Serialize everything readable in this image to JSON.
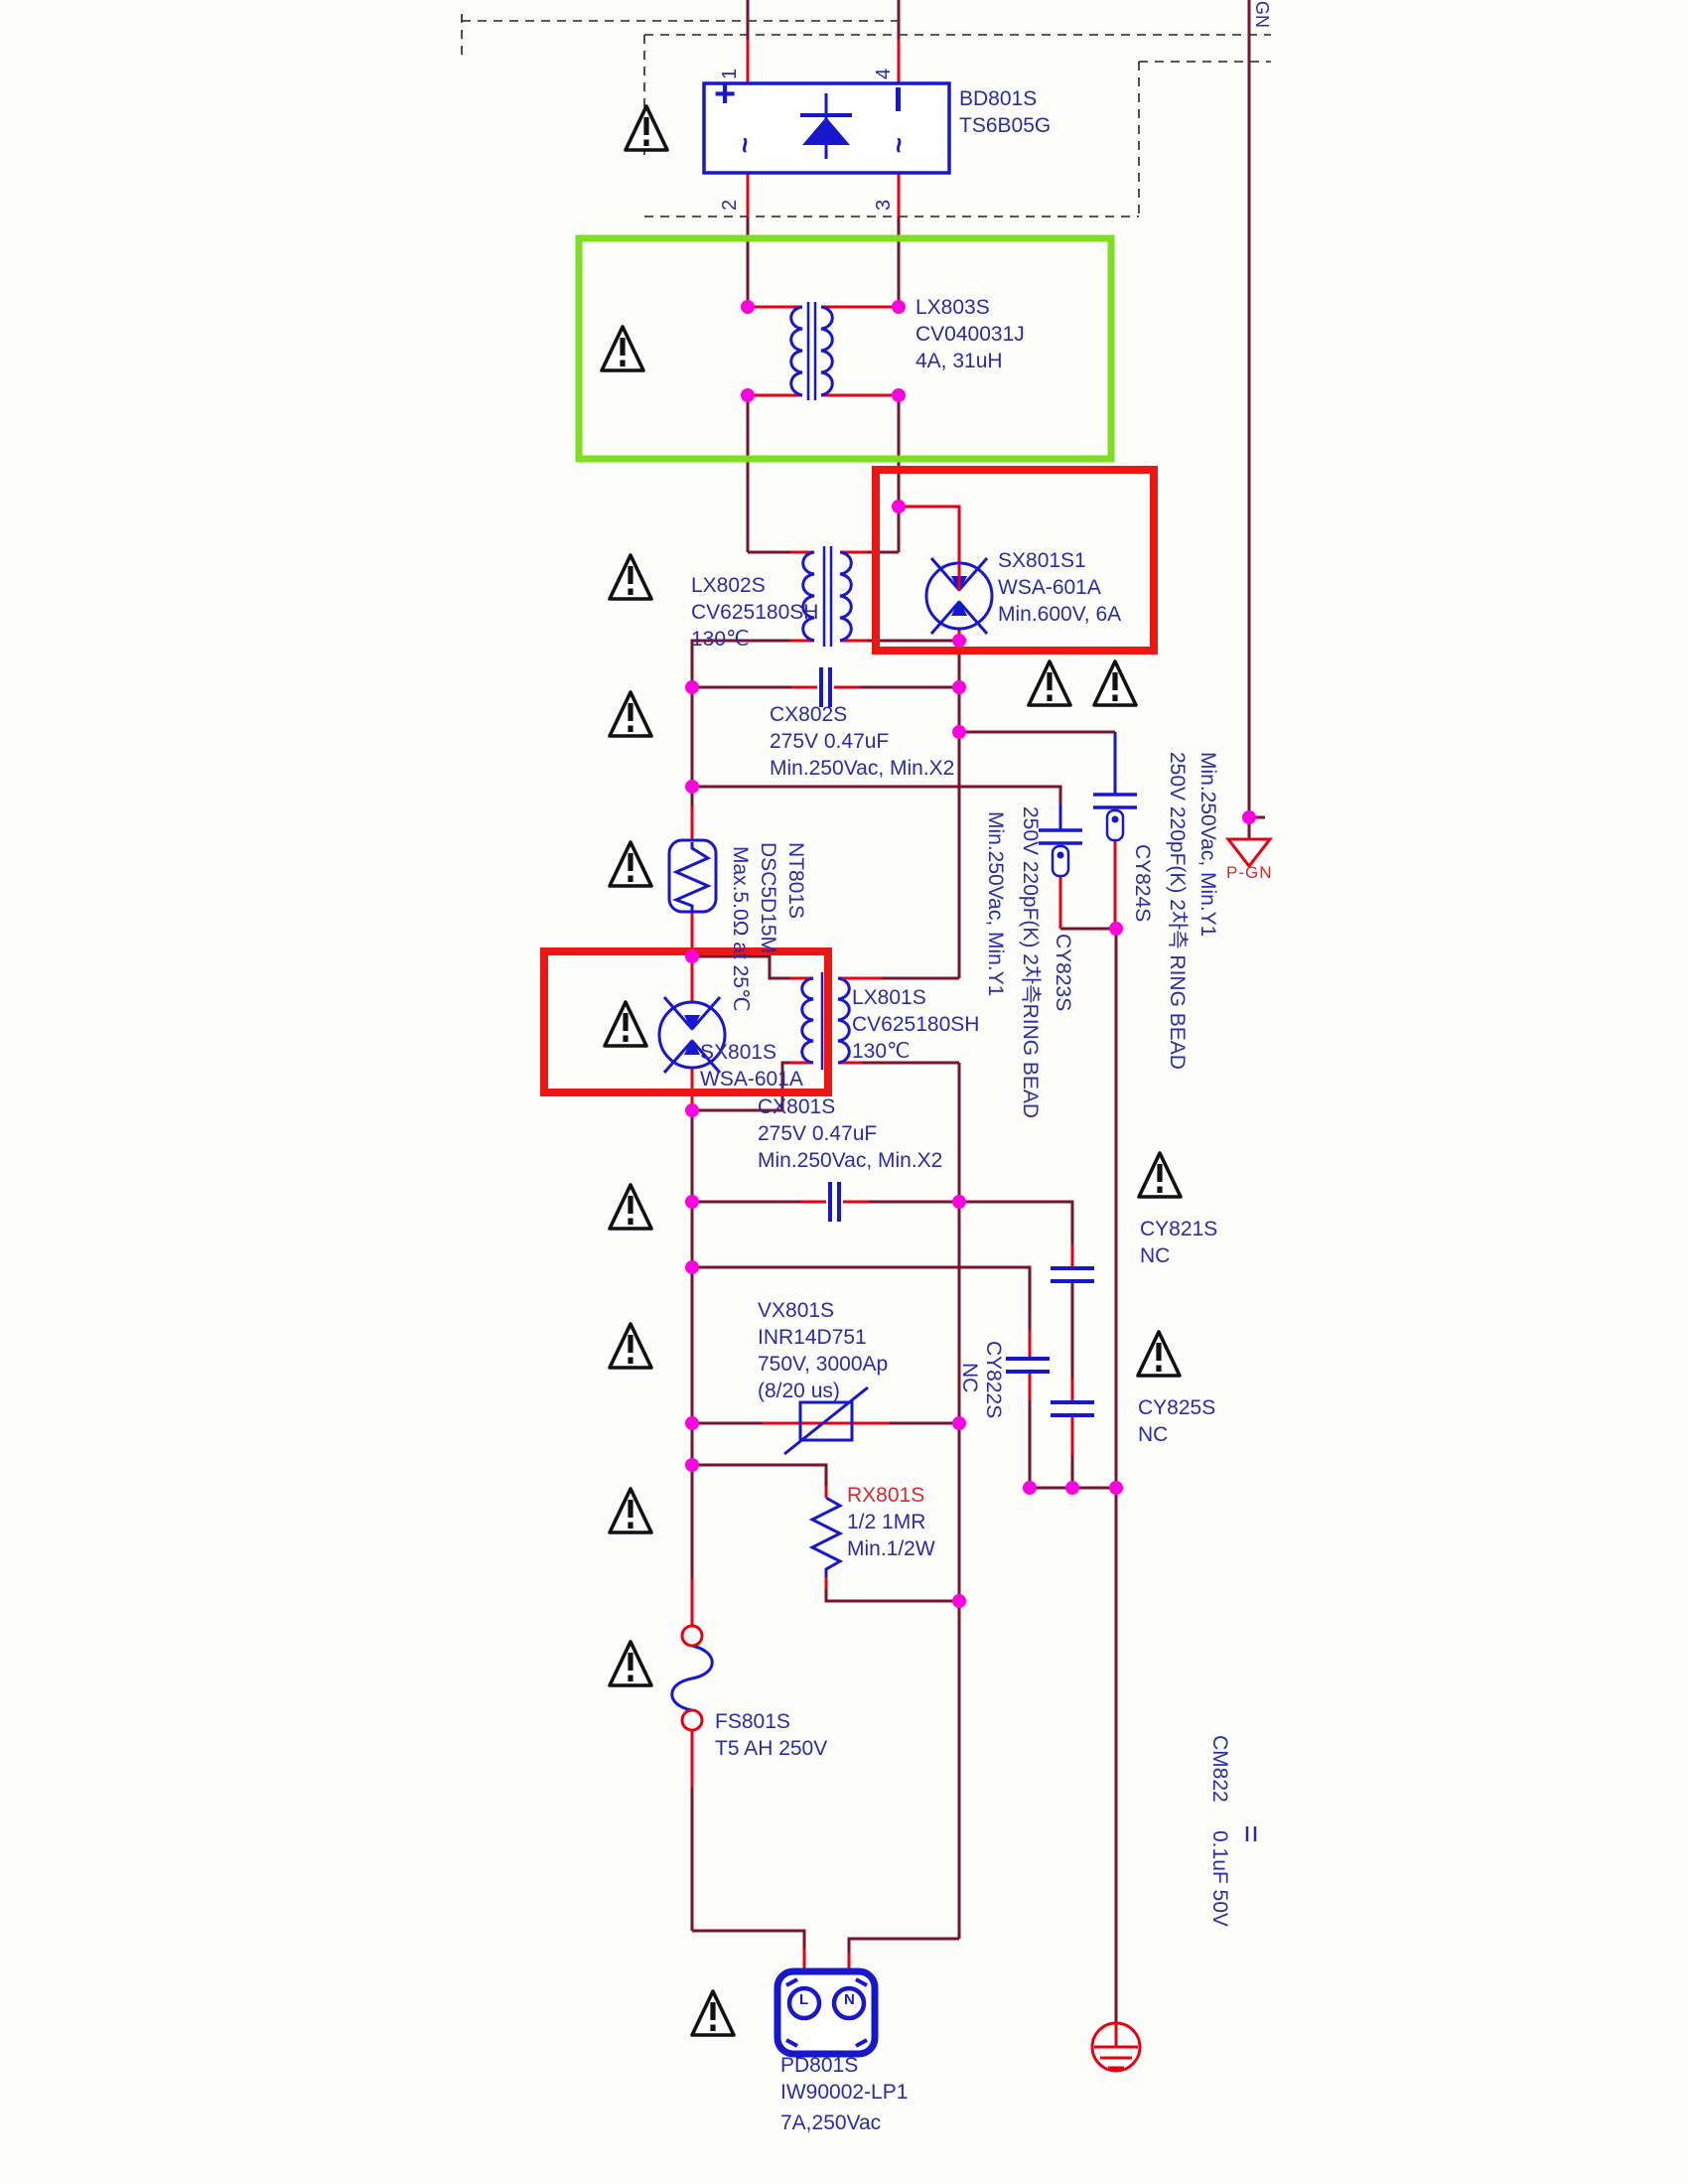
{
  "colors": {
    "wire": "#77142E",
    "pin_stub": "#EA0012",
    "component_blue": "#1717CE",
    "label_navy": "#2B2BA6",
    "junction_magenta": "#FF00E0",
    "highlight_red_box": "#EE1515",
    "highlight_green_box": "#7CDF1F",
    "label_red": "#D42B2B",
    "earth_red": "#E8000F"
  },
  "components": {
    "bd801s": {
      "ref": "BD801S",
      "part": "TS6B05G"
    },
    "bridge_pins": {
      "p1": "1",
      "p2": "2",
      "p3": "3",
      "p4": "4",
      "plus": "+",
      "ac_left": "~",
      "ac_right": "~"
    },
    "lx803s": {
      "ref": "LX803S",
      "part": "CV040031J",
      "spec": "4A, 31uH"
    },
    "sx801s1": {
      "ref": "SX801S1",
      "part": "WSA-601A",
      "spec": "Min.600V, 6A"
    },
    "lx802s": {
      "ref": "LX802S",
      "part": "CV625180SH",
      "temp": "130℃"
    },
    "cx802s": {
      "ref": "CX802S",
      "value": "275V 0.47uF",
      "spec": "Min.250Vac, Min.X2"
    },
    "cy823s": {
      "ref": "CY823S",
      "spec": "250V 220pF(K) 2차측RING BEAD",
      "rating": "Min.250Vac, Min.Y1"
    },
    "cy824s": {
      "ref": "CY824S",
      "spec": "250V 220pF(K) 2차측 RING BEAD",
      "rating": "Min.250Vac, Min.Y1"
    },
    "nt801s": {
      "ref": "NT801S",
      "part": "DSC5D15M",
      "spec": "Max.5.0Ω at 25℃"
    },
    "sx801s": {
      "ref": "SX801S",
      "part": "WSA-601A"
    },
    "lx801s": {
      "ref": "LX801S",
      "part": "CV625180SH",
      "temp": "130℃"
    },
    "cx801s": {
      "ref": "CX801S",
      "value": "275V 0.47uF",
      "spec": "Min.250Vac, Min.X2"
    },
    "cy821s": {
      "ref": "CY821S",
      "status": "NC"
    },
    "cy822s": {
      "ref": "CY822S",
      "status": "NC"
    },
    "cy825s": {
      "ref": "CY825S",
      "status": "NC"
    },
    "vx801s": {
      "ref": "VX801S",
      "part": "INR14D751",
      "spec": "750V, 3000Ap",
      "pulse": "(8/20 us)"
    },
    "rx801s": {
      "ref": "RX801S",
      "value": "1/2 1MR",
      "spec": "Min.1/2W"
    },
    "fs801s": {
      "ref": "FS801S",
      "spec": "T5 AH 250V"
    },
    "cm822": {
      "ref": "CM822",
      "value": "0.1uF 50V"
    },
    "pd801s": {
      "ref": "PD801S",
      "part": "IW90002-LP1",
      "spec": "7A,250Vac",
      "pin_l": "L",
      "pin_n": "N"
    },
    "pgn": {
      "label": "P-GN"
    },
    "edge_label_fragment": "GN"
  }
}
